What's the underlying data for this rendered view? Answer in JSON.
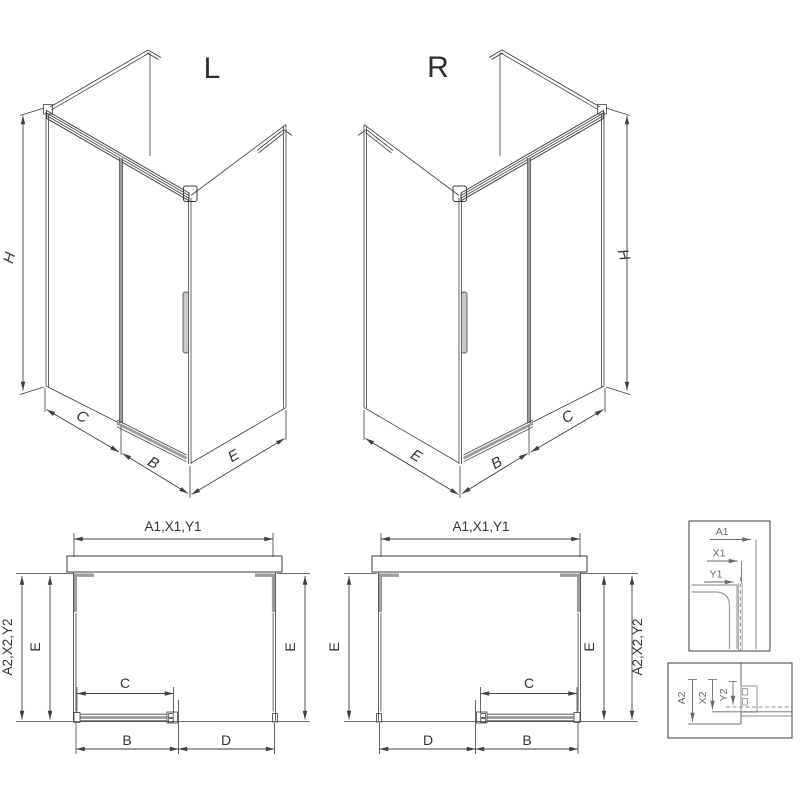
{
  "title": {
    "left_variant": "L",
    "right_variant": "R"
  },
  "iso_dims": {
    "height": "H",
    "fixed_width": "C",
    "door_width": "B",
    "side_depth": "E"
  },
  "plan_dims": {
    "total_width": "A1,X1,Y1",
    "total_depth": "A2,X2,Y2",
    "depth_inner": "E",
    "door_travel": "C",
    "door_width": "B",
    "opening": "D"
  },
  "detail_top": {
    "dim1": "A1",
    "dim2": "X1",
    "dim3": "Y1"
  },
  "detail_bottom": {
    "dim1": "A2",
    "dim2": "X2",
    "dim3": "Y2"
  },
  "colors": {
    "line": "#3f3f3f",
    "profile_gray": "#9c9c9c",
    "detail_line": "#6a6a6a",
    "background": "#ffffff"
  }
}
